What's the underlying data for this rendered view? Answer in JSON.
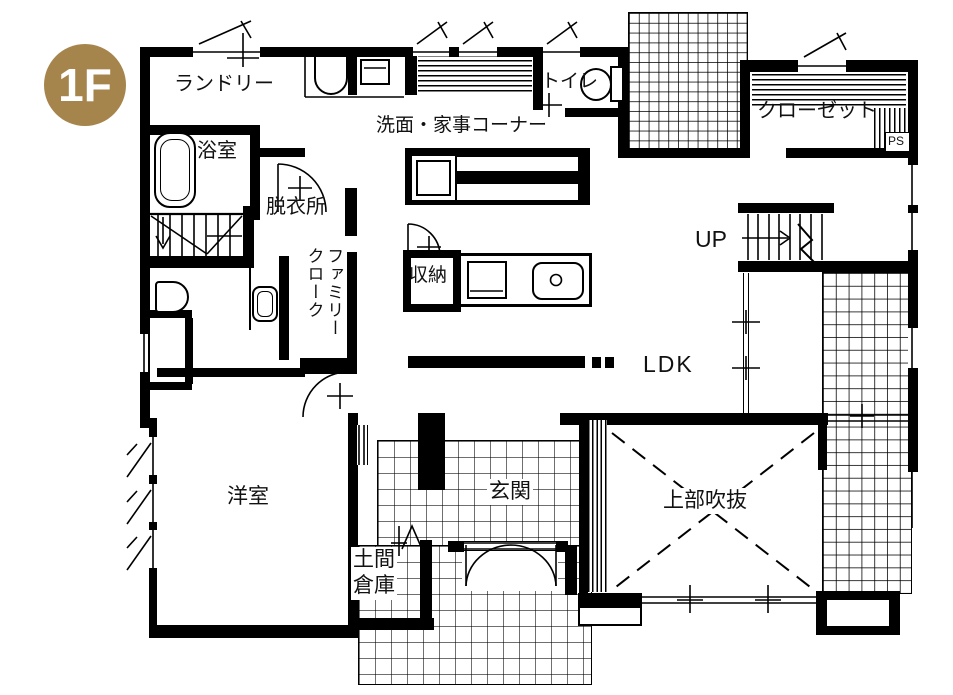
{
  "meta": {
    "floor_badge": "1F",
    "badge_color": "#a6854c",
    "line_color": "#000000",
    "bg_color": "#ffffff"
  },
  "rooms": {
    "laundry": {
      "label": "ランドリー"
    },
    "bath": {
      "label": "浴室"
    },
    "dressing": {
      "label": "脱衣所"
    },
    "utility": {
      "label": "洗面・家事コーナー"
    },
    "toilet": {
      "label": "トイレ"
    },
    "closet": {
      "label": "クローゼット"
    },
    "pipe_space": {
      "label": "PS"
    },
    "stairs": {
      "label": "UP"
    },
    "storage": {
      "label": "収納"
    },
    "family_cloak": {
      "label": "ファミリー\nクローク"
    },
    "ldk": {
      "label": "LDK"
    },
    "western_room": {
      "label": "洋室"
    },
    "entrance": {
      "label": "玄関"
    },
    "doma_storage": {
      "label": "土間\n倉庫"
    },
    "void": {
      "label": "上部吹抜"
    }
  }
}
